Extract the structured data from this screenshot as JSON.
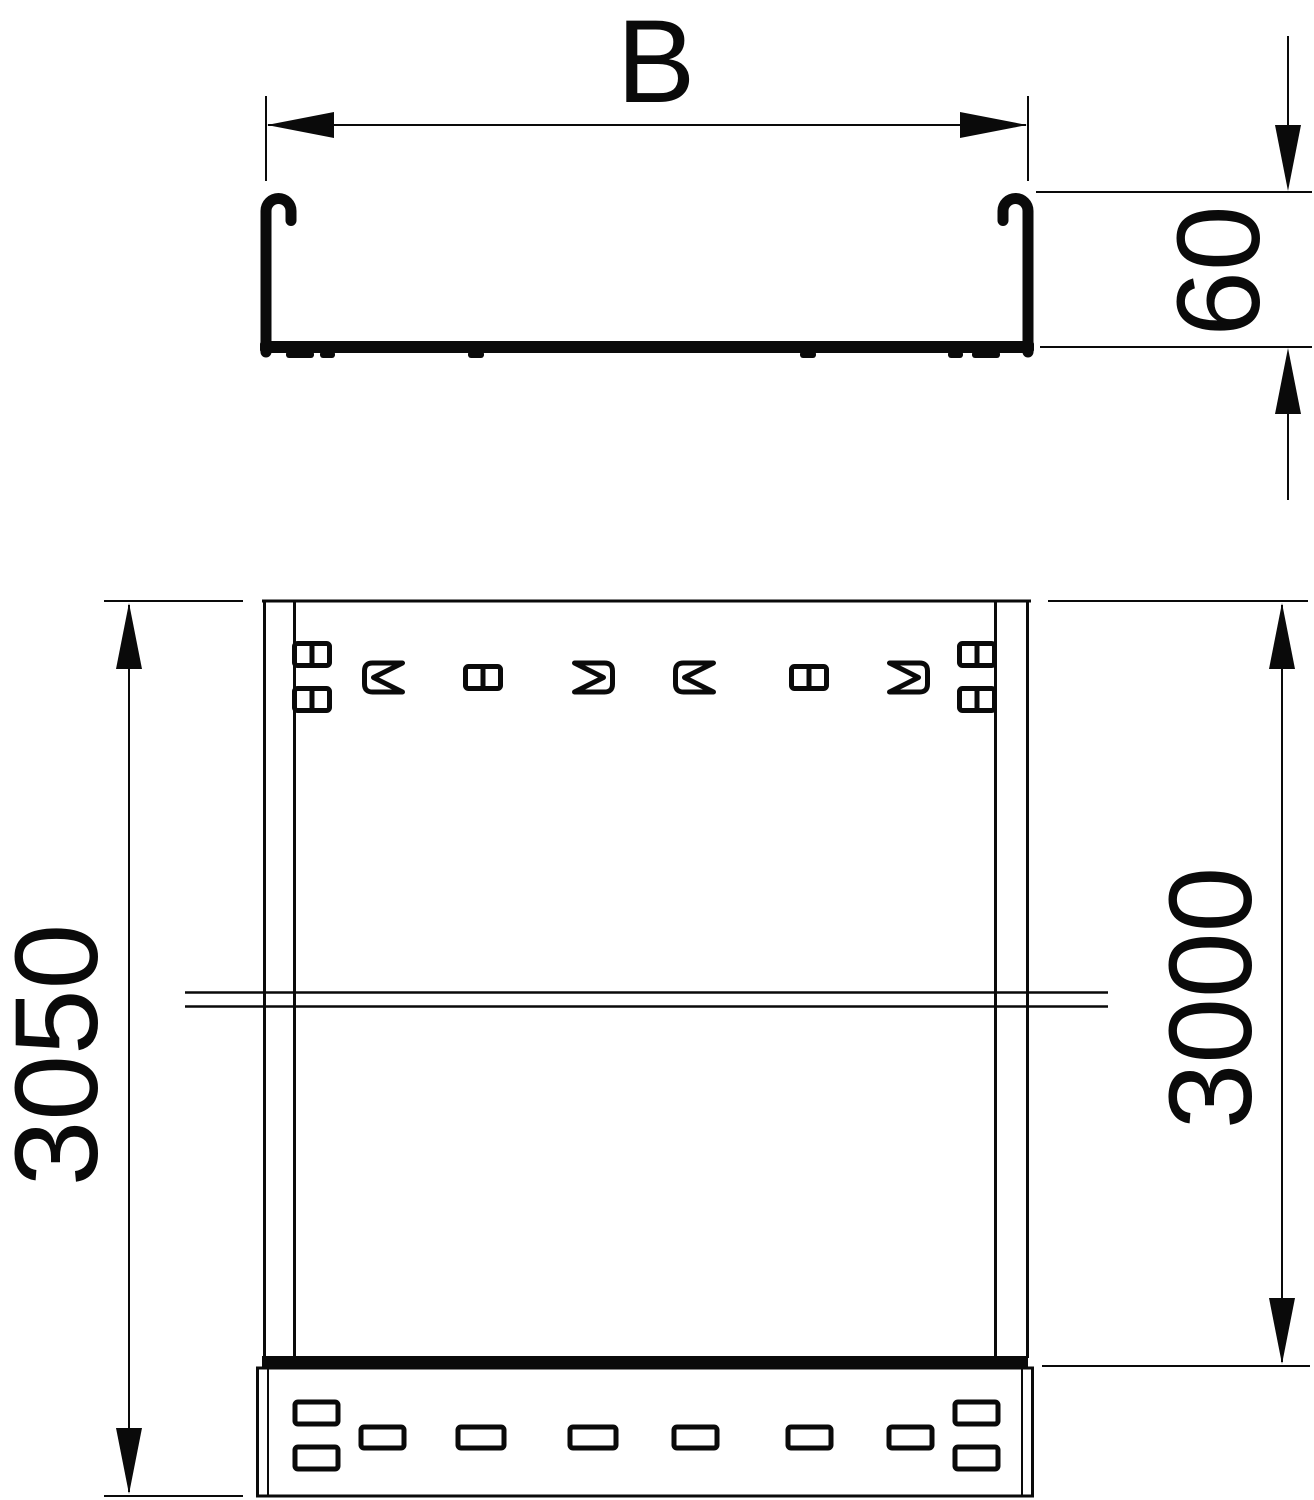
{
  "page": {
    "background": "#ffffff",
    "description": "Technical dimension drawing of a cable tray: cross-section view (top) and plan view (bottom) with break lines and a coupler end piece"
  },
  "colors": {
    "line": "#0a0a0a",
    "background": "#ffffff"
  },
  "drawing": {
    "dimensions": {
      "width_label": "B",
      "height_label": "60",
      "overall_length_label": "3050",
      "rail_length_label": "3000"
    }
  }
}
